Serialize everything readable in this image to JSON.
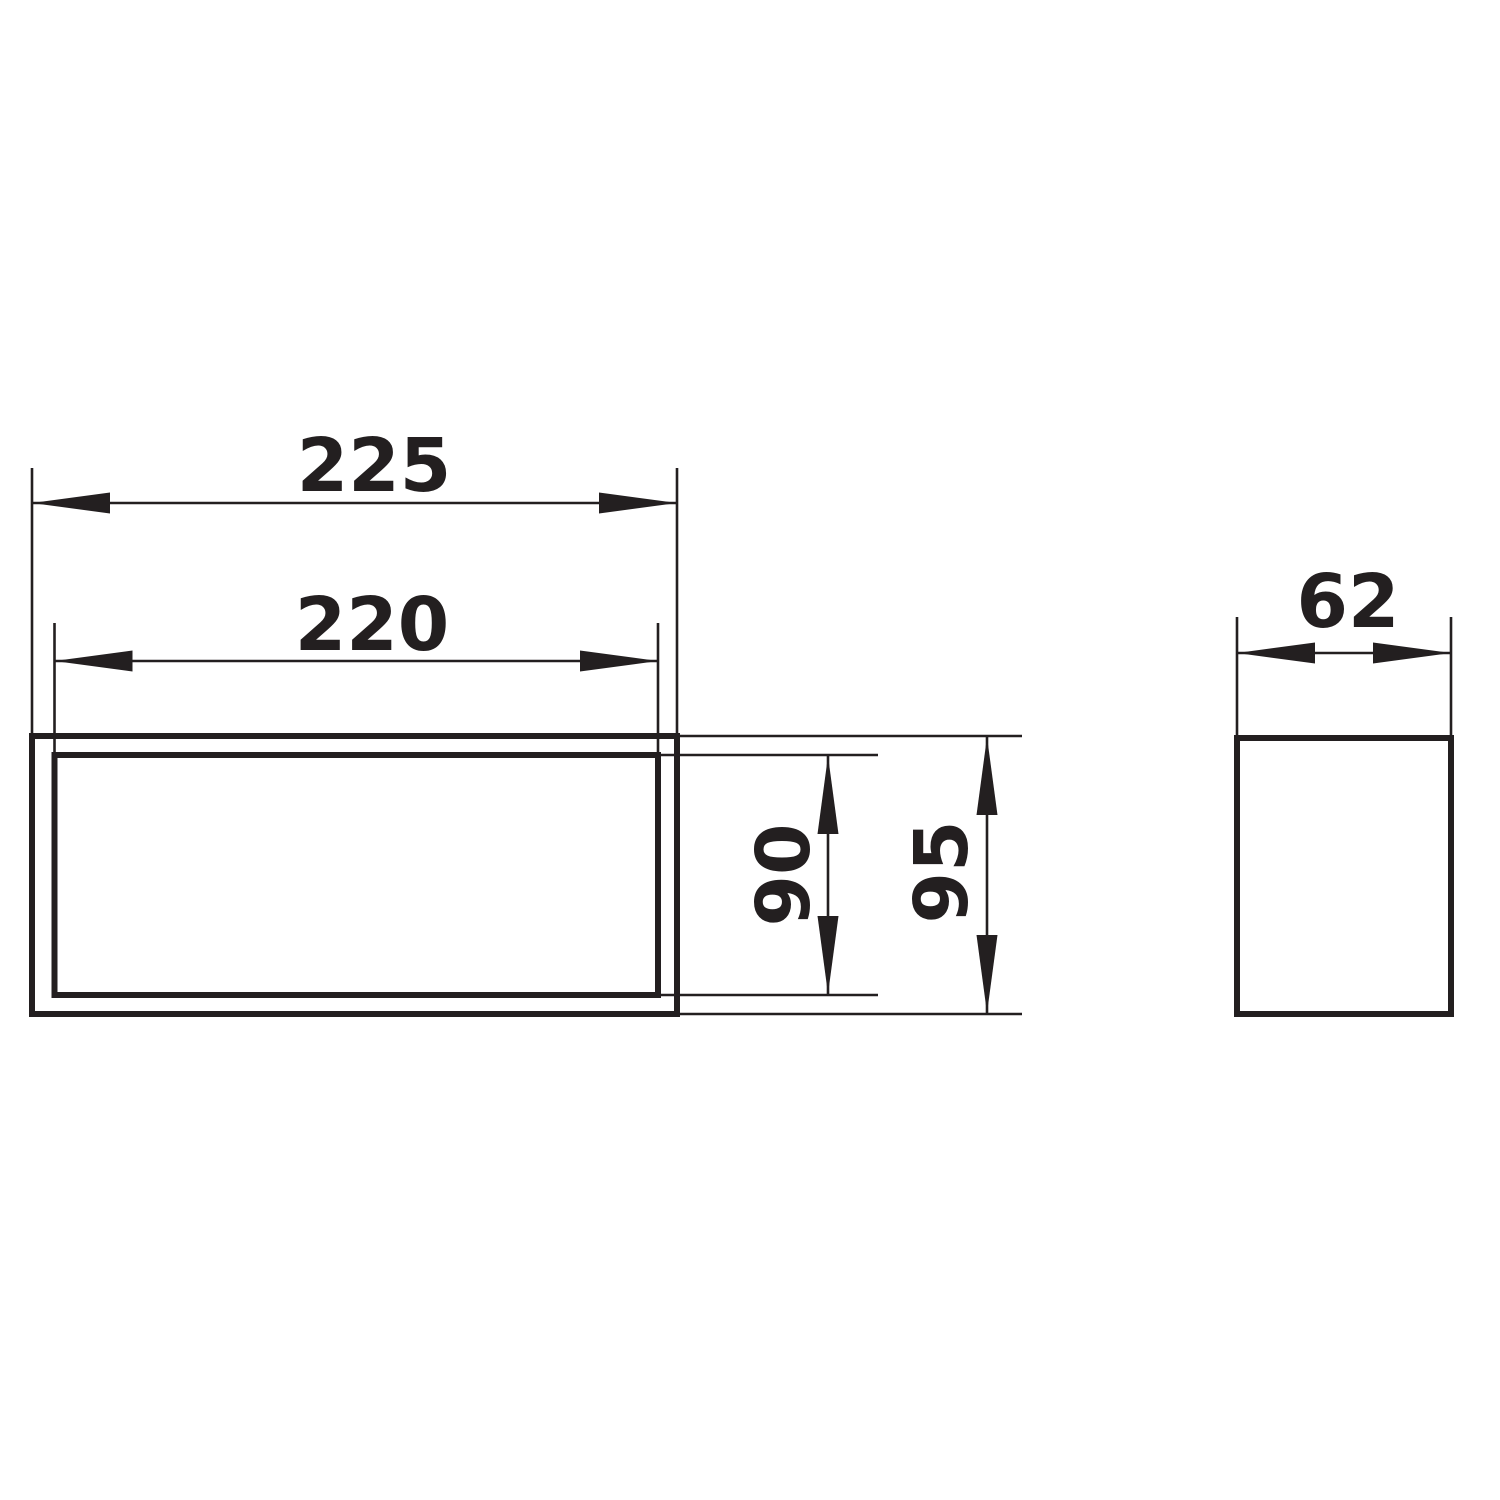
{
  "drawing": {
    "description": "Technical dimension drawing with two orthographic views of a flat rectangular duct connector",
    "line_color": "#231f20",
    "background_color": "#ffffff",
    "front_view": {
      "outer_width_label": "225",
      "inner_width_label": "220",
      "inner_height_label": "90",
      "outer_height_label": "95"
    },
    "side_view": {
      "width_label": "62"
    }
  }
}
